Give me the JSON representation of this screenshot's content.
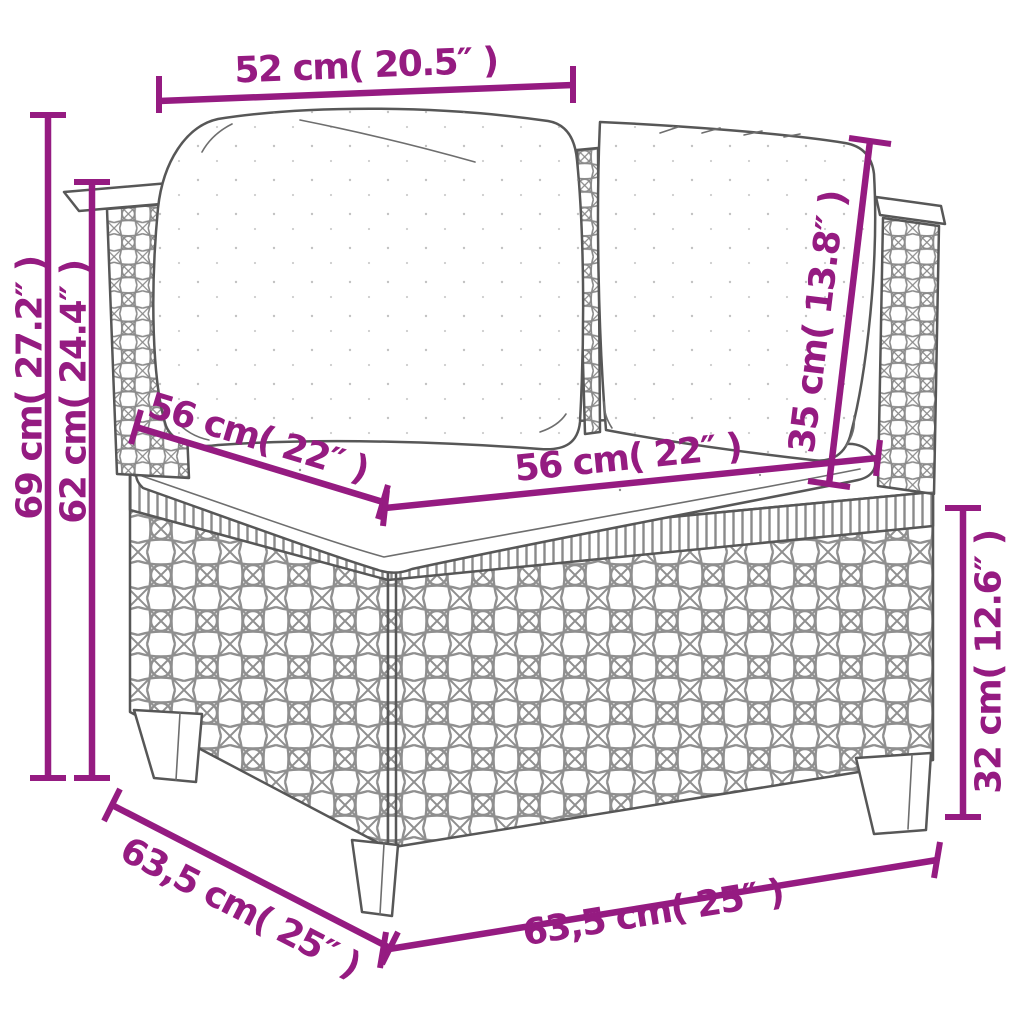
{
  "canvas": {
    "width": 1024,
    "height": 1024,
    "background": "#ffffff"
  },
  "style": {
    "accent_color": "#951B81",
    "drawing_line_color": "#575757",
    "weave_color": "#8f8f8f"
  },
  "drawing": {
    "subject": "poly rattan corner sofa section with back cushions and seat cushion"
  },
  "dimensions": {
    "back_width_top": "52 cm( 20.5″ )",
    "overall_height": "69 cm( 27.2″ )",
    "backrest_height": "62 cm( 24.4″ )",
    "seat_depth_left": "56 cm( 22″ )",
    "seat_width_front": "56 cm( 22″ )",
    "back_cushion_height": "35 cm( 13.8″ )",
    "base_height": "32 cm( 12.6″ )",
    "overall_depth": "63,5 cm( 25″ )",
    "overall_width": "63,5 cm( 25″ )"
  }
}
